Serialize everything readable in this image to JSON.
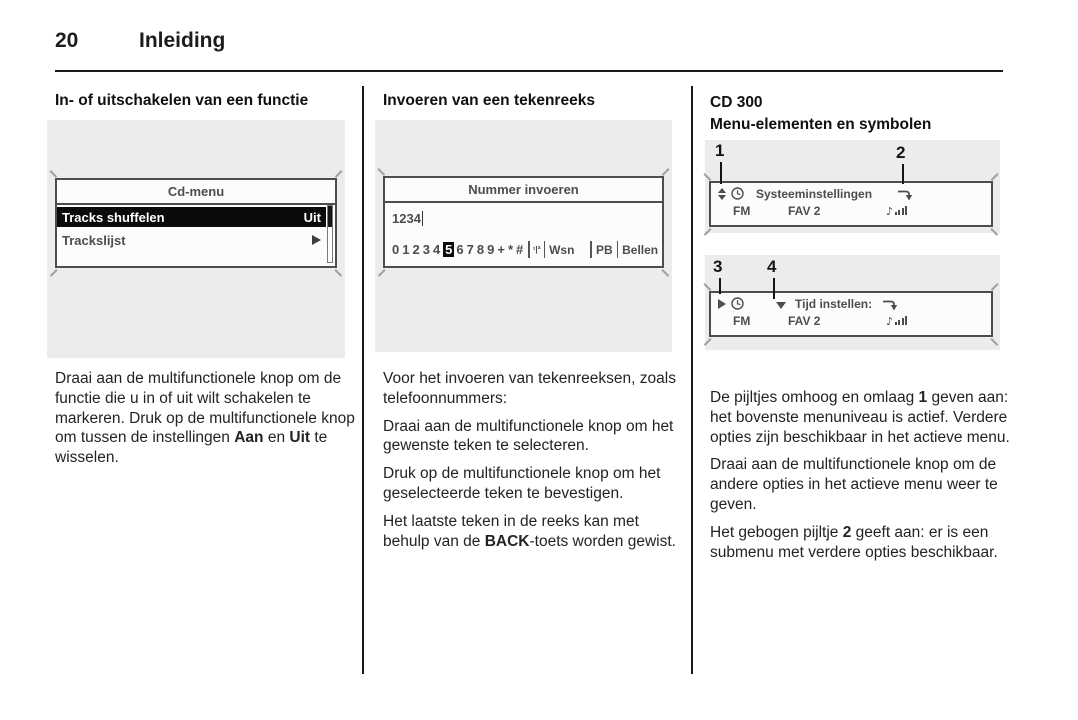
{
  "page": {
    "number": "20",
    "title": "Inleiding"
  },
  "colors": {
    "figure_bg": "#ececec",
    "display_border": "#4d4d4d",
    "selected_row_bg": "#0b0b0b",
    "text": "#1c1c1c"
  },
  "columns": {
    "col1": {
      "heading": "In- of uitschakelen van een functie",
      "screen": {
        "title": "Cd-menu",
        "selected_row": {
          "label": "Tracks shuffelen",
          "value": "Uit"
        },
        "row2": {
          "label": "Trackslijst"
        }
      },
      "paragraphs": [
        [
          {
            "t": "Draai aan de multifunctionele knop om de functie die u in of uit wilt scha­kelen te markeren. Druk op de multi­functionele knop om tussen de instel­lingen "
          },
          {
            "t": "Aan",
            "b": true
          },
          {
            "t": " en "
          },
          {
            "t": "Uit",
            "b": true
          },
          {
            "t": " te wisselen."
          }
        ]
      ]
    },
    "col2": {
      "heading": "Invoeren van een tekenreeks",
      "screen": {
        "title": "Nummer invoeren",
        "input_value": "1234",
        "chars": [
          "0",
          "1",
          "2",
          "3",
          "4",
          "5",
          "6",
          "7",
          "8",
          "9",
          "+",
          "*",
          "#"
        ],
        "selected_char": "5",
        "charset_symbol": "¹|ª",
        "actions": {
          "wsn": "Wsn",
          "pb": "PB",
          "bellen": "Bellen"
        }
      },
      "paragraphs": [
        [
          {
            "t": "Voor het invoeren van tekenreeksen, zoals telefoonnummers:"
          }
        ],
        [
          {
            "t": "Draai aan de multifunctionele knop om het gewenste teken te selecteren."
          }
        ],
        [
          {
            "t": "Druk op de multifunctionele knop om het geselecteerde teken te bevesti­gen."
          }
        ],
        [
          {
            "t": "Het laatste teken in de reeks kan met behulp van de "
          },
          {
            "t": "BACK",
            "b": true
          },
          {
            "t": "-toets worden gewist."
          }
        ]
      ]
    },
    "col3": {
      "heading_line1": "CD 300",
      "heading_line2": "Menu-elementen en symbolen",
      "figure1": {
        "callouts": [
          "1",
          "2"
        ],
        "screen": {
          "menu_title": "Systeeminstellingen",
          "band": "FM",
          "preset": "FAV 2"
        }
      },
      "figure2": {
        "callouts": [
          "3",
          "4"
        ],
        "screen": {
          "menu_title": "Tijd instellen:",
          "band": "FM",
          "preset": "FAV 2"
        }
      },
      "paragraphs": [
        [
          {
            "t": "De pijltjes omhoog en omlaag "
          },
          {
            "t": "1",
            "b": true
          },
          {
            "t": " ge­ven aan: het bovenste menuniveau is actief. Verdere opties zijn beschik­baar in het actieve menu."
          }
        ],
        [
          {
            "t": "Draai aan de multifunctionele knop om de andere opties in het actieve menu weer te geven."
          }
        ],
        [
          {
            "t": "Het gebogen pijltje "
          },
          {
            "t": "2",
            "b": true
          },
          {
            "t": " geeft aan: er is een submenu met verdere opties be­schikbaar."
          }
        ]
      ]
    }
  }
}
